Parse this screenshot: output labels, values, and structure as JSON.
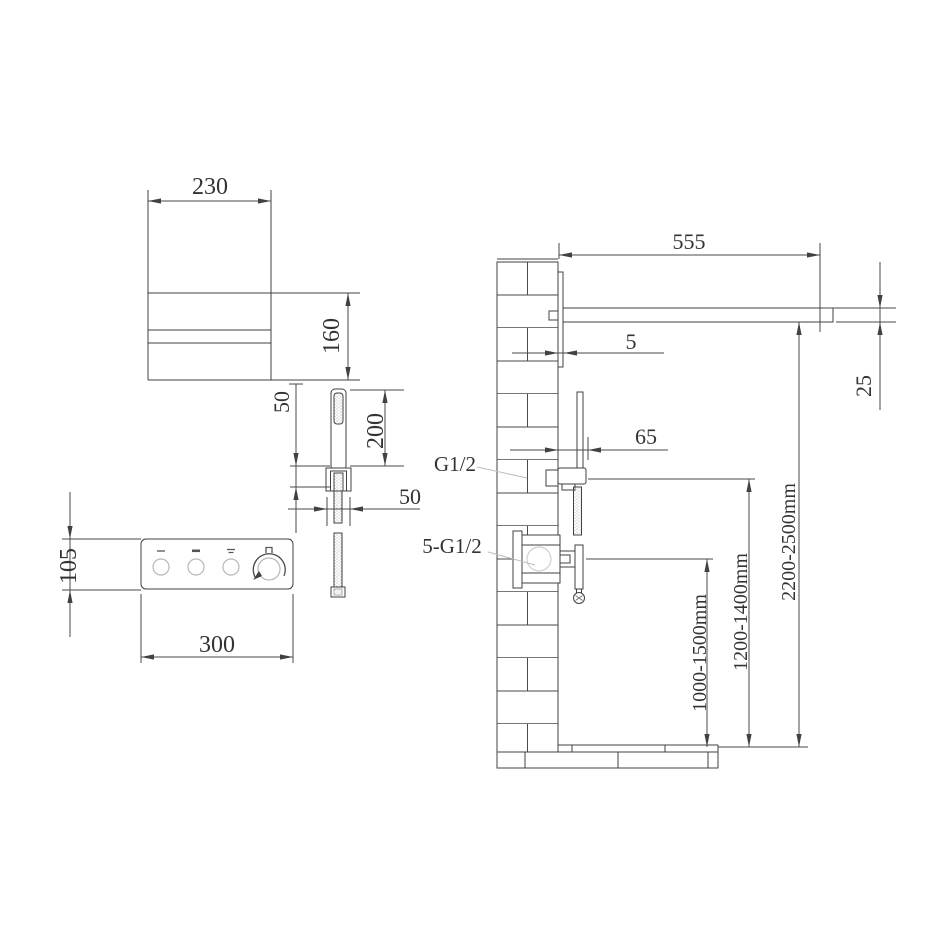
{
  "drawing_type": "shower-system-installation-technical-drawing",
  "colors": {
    "background": "#ffffff",
    "line": "#414141",
    "text": "#333333",
    "light_line": "#bdbdbd"
  },
  "views": {
    "spout_front": {
      "width": "230",
      "height": "160"
    },
    "hand_shower_front": {
      "connector_length": "50",
      "handle_length": "200",
      "connector_width": "50"
    },
    "control_panel_front": {
      "height": "105",
      "width": "300"
    },
    "installation_side": {
      "arm_projection": "555",
      "plate_thickness": "5",
      "arm_thickness": "25",
      "hand_shower_offset": "65",
      "outlet_thread": "G1/2",
      "valve_thread": "5-G1/2",
      "arm_height": "2200-2500mm",
      "hand_shower_height": "1200-1400mm",
      "valve_height": "1000-1500mm"
    }
  }
}
